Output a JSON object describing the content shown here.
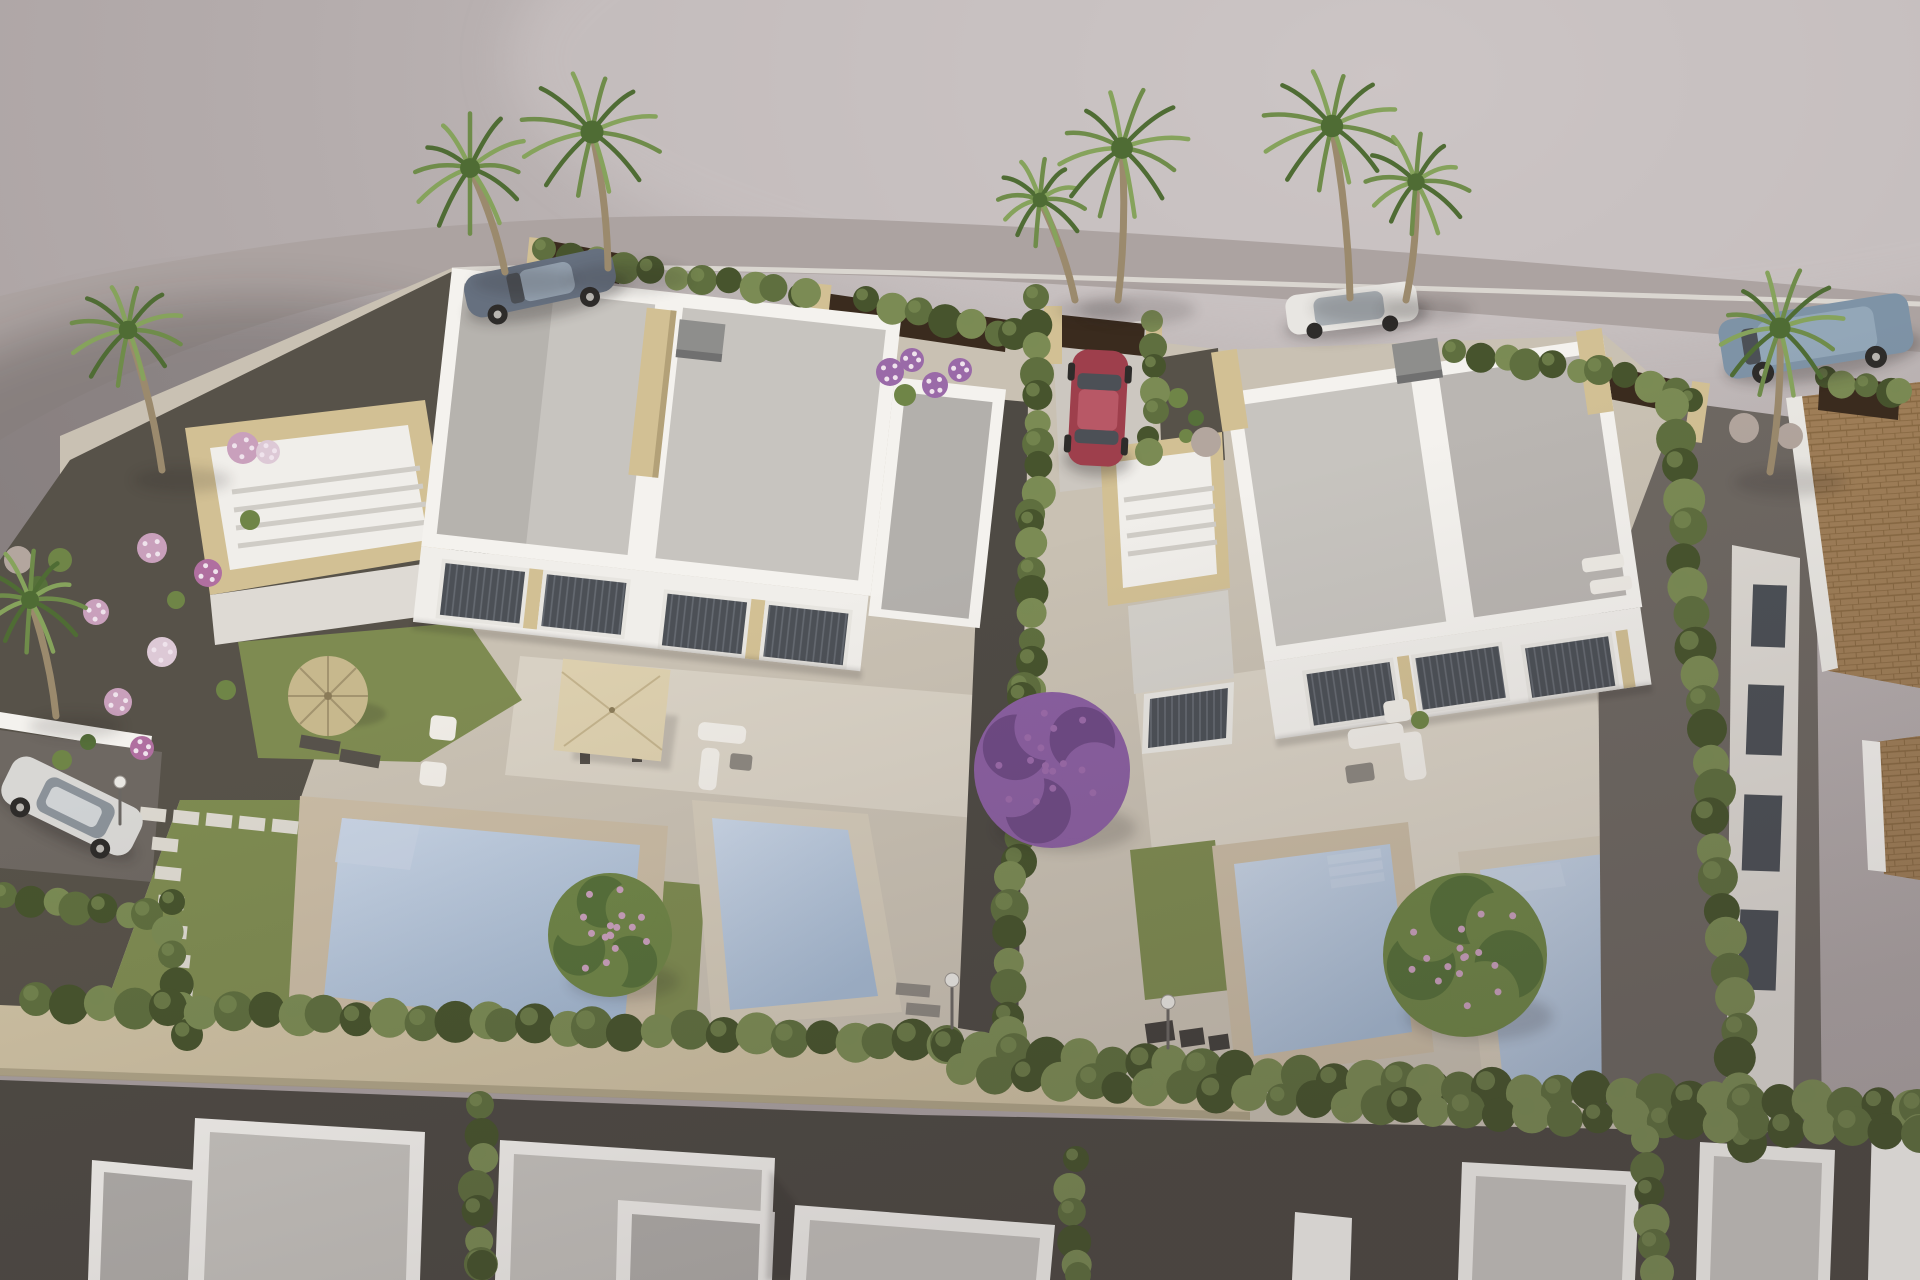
{
  "meta": {
    "description": "Aerial 3D architectural rendering of a new residential development: two white modern semi-detached villas with flat gravel roofs, rooftop solariums, glazed facades, private terraces with parasols and garden furniture, four private swimming pools, lawns, gravel gardens with flowering shrubs, cypress hedges, palm trees, a perimeter stone wall, neighbouring flat-roofed houses below, an existing terracotta-roofed house at right, and five parked cars on the surrounding road."
  },
  "scene": {
    "objects": [
      "left duplex villa",
      "right duplex villa",
      "rooftop solarium left",
      "rooftop solarium right",
      "pool A",
      "pool B",
      "pool C",
      "pool D",
      "straw parasol",
      "beige square parasol",
      "outdoor sofa set",
      "sun loungers",
      "gray sports car",
      "red hatchback",
      "white car",
      "blue SUV",
      "silver hatchback",
      "palm trees",
      "cypress hedges",
      "bougainvillea tree",
      "fruit trees",
      "perimeter stone wall",
      "terracotta roof house",
      "neighbouring flat roofs",
      "street lamps"
    ]
  },
  "palette": {
    "background": "#b4acac",
    "background_light": "#cbc4c4",
    "road": "#aca3a1",
    "plot_base": "#c9c1b3",
    "gravel_garden": "#575249",
    "gravel_path": "#6e6862",
    "dark_path": "#4e4a44",
    "lawn": "#7e8b51",
    "lawn_dark": "#66753f",
    "deck": "#d8d1c4",
    "parapet": "#f4f2ee",
    "roof_gravel": "#c7c4bf",
    "roof_gravel_dark": "#b3b0ac",
    "wall_white": "#f0eeea",
    "wall_shade": "#dedad4",
    "stone": "#d2c094",
    "stone_dark": "#b3a178",
    "window_frame": "#e7e5e0",
    "glass": "#4c5056",
    "blind": "#666b72",
    "pool_stone": "#c9bba4",
    "pool_stone_2": "#d2c9b8",
    "pool_light": "#c6d2e2",
    "wall_stone": "#cec1a3",
    "fence_dark": "#3a2b1e",
    "terracotta": "#a07f58",
    "terracotta_dark": "#84653e",
    "parasol": "#dccfae",
    "parasol_line": "#c2b28c",
    "thatch": "#c7b88d",
    "thatch_line": "#a3946f",
    "trunk": "#9b8a6d",
    "palm_green": "#6f8c4a",
    "palm_dark": "#4f6c34",
    "palm_light": "#86a35c",
    "hedge": "#5f6f3f",
    "hedge_dark": "#47542d",
    "hedge_light": "#7b8b54",
    "canopy_green": "#6f8547",
    "canopy_green_dark": "#56703a",
    "bougainvillea": "#8a5fa0",
    "bougainvillea_dark": "#6e4a84",
    "flower_pink": "#c9a0bc",
    "flower_white": "#ddc9d6",
    "flower_magenta": "#b06fa0",
    "flower_purple": "#9a6aa8",
    "stone_ball": "#b3a69e",
    "car_red": "#9e3f4c",
    "car_red_light": "#b85866",
    "car_gray": "#66707f",
    "car_gray_light": "#93a0ae",
    "car_white": "#e8e6e2",
    "car_suv": "#7e93a6",
    "car_suv_light": "#93a7b8",
    "car_silver": "#d8d7d4",
    "furn_white": "#efece6",
    "furn_dark": "#57524b",
    "furn_gray": "#8c8780",
    "metal": "#6b6763",
    "box_dark": "#45413d",
    "chimney": "#8e8e8c",
    "chimney_dark": "#707070",
    "step_white": "#ebe9e4"
  },
  "vegetation": {
    "hedges_back": [
      {
        "pts": [
          [
            548,
            252
          ],
          [
            700,
            280
          ],
          [
            808,
            294
          ]
        ],
        "r": 14,
        "step": 26
      },
      {
        "pts": [
          [
            868,
            302
          ],
          [
            1010,
            334
          ]
        ],
        "r": 15,
        "step": 26
      },
      {
        "pts": [
          [
            1152,
            324
          ],
          [
            1152,
            452
          ]
        ],
        "r": 13,
        "step": 22
      },
      {
        "pts": [
          [
            1452,
            354
          ],
          [
            1600,
            370
          ],
          [
            1688,
            398
          ]
        ],
        "r": 14,
        "step": 26
      },
      {
        "pts": [
          [
            1822,
            380
          ],
          [
            1900,
            392
          ]
        ],
        "r": 13,
        "step": 24
      }
    ],
    "hedges_mid": [
      {
        "pts": [
          [
            1040,
            300
          ],
          [
            1034,
            520
          ],
          [
            1028,
            690
          ]
        ],
        "r": 15,
        "step": 24
      },
      {
        "pts": [
          [
            1024,
            700
          ],
          [
            1014,
            880
          ],
          [
            1006,
            1035
          ]
        ],
        "r": 17,
        "step": 27
      },
      {
        "pts": [
          [
            1672,
            408
          ],
          [
            1702,
            700
          ],
          [
            1732,
            1000
          ],
          [
            1748,
            1140
          ]
        ],
        "r": 19,
        "step": 30
      },
      {
        "pts": [
          [
            2,
            898
          ],
          [
            148,
            914
          ]
        ],
        "r": 15,
        "step": 26
      },
      {
        "pts": [
          [
            168,
            905
          ],
          [
            186,
            1035
          ]
        ],
        "r": 15,
        "step": 26
      }
    ],
    "hedges_bottom": [
      {
        "pts": [
          [
            40,
            1002
          ],
          [
            500,
            1024
          ],
          [
            948,
            1044
          ]
        ],
        "r": 19,
        "step": 32
      },
      {
        "pts": [
          [
            950,
            1048
          ],
          [
            1430,
            1086
          ],
          [
            1914,
            1108
          ]
        ],
        "r": 19,
        "step": 32
      },
      {
        "pts": [
          [
            962,
            1072
          ],
          [
            1436,
            1110
          ],
          [
            1916,
            1132
          ]
        ],
        "r": 18,
        "step": 32
      },
      {
        "pts": [
          [
            478,
            1108
          ],
          [
            482,
            1268
          ]
        ],
        "r": 16,
        "step": 26
      },
      {
        "pts": [
          [
            1072,
            1162
          ],
          [
            1078,
            1272
          ]
        ],
        "r": 15,
        "step": 26
      },
      {
        "pts": [
          [
            1648,
            1142
          ],
          [
            1654,
            1272
          ]
        ],
        "r": 16,
        "step": 26
      }
    ],
    "palms": [
      {
        "x": 470,
        "y": 168,
        "r": 62,
        "tx": 505,
        "ty": 272
      },
      {
        "x": 592,
        "y": 132,
        "r": 72,
        "tx": 608,
        "ty": 268
      },
      {
        "x": 1040,
        "y": 200,
        "r": 46,
        "tx": 1075,
        "ty": 300
      },
      {
        "x": 1122,
        "y": 148,
        "r": 68,
        "tx": 1118,
        "ty": 300
      },
      {
        "x": 1332,
        "y": 126,
        "r": 70,
        "tx": 1350,
        "ty": 298
      },
      {
        "x": 1416,
        "y": 182,
        "r": 54,
        "tx": 1406,
        "ty": 300
      },
      {
        "x": 1780,
        "y": 328,
        "r": 66,
        "tx": 1770,
        "ty": 472
      },
      {
        "x": 128,
        "y": 330,
        "r": 58,
        "tx": 162,
        "ty": 470
      },
      {
        "x": 30,
        "y": 600,
        "r": 56,
        "tx": 56,
        "ty": 716
      }
    ],
    "shrubs": [
      {
        "x": 243,
        "y": 448,
        "r": 16,
        "c": "flower_pink"
      },
      {
        "x": 268,
        "y": 452,
        "r": 12,
        "c": "flower_white"
      },
      {
        "x": 152,
        "y": 548,
        "r": 15,
        "c": "flower_pink"
      },
      {
        "x": 208,
        "y": 573,
        "r": 14,
        "c": "flower_magenta"
      },
      {
        "x": 96,
        "y": 612,
        "r": 13,
        "c": "flower_pink"
      },
      {
        "x": 162,
        "y": 652,
        "r": 15,
        "c": "flower_white"
      },
      {
        "x": 118,
        "y": 702,
        "r": 14,
        "c": "flower_pink"
      },
      {
        "x": 142,
        "y": 748,
        "r": 12,
        "c": "flower_magenta"
      },
      {
        "x": 226,
        "y": 690,
        "r": 10,
        "c": "canopy_green"
      },
      {
        "x": 176,
        "y": 600,
        "r": 9,
        "c": "canopy_green"
      },
      {
        "x": 60,
        "y": 560,
        "r": 12,
        "c": "canopy_green"
      },
      {
        "x": 250,
        "y": 520,
        "r": 10,
        "c": "canopy_green"
      },
      {
        "x": 62,
        "y": 760,
        "r": 10,
        "c": "canopy_green"
      },
      {
        "x": 88,
        "y": 742,
        "r": 8,
        "c": "canopy_green_dark"
      },
      {
        "x": 890,
        "y": 372,
        "r": 14,
        "c": "flower_purple"
      },
      {
        "x": 912,
        "y": 360,
        "r": 12,
        "c": "flower_purple"
      },
      {
        "x": 935,
        "y": 385,
        "r": 13,
        "c": "flower_purple"
      },
      {
        "x": 960,
        "y": 370,
        "r": 12,
        "c": "flower_purple"
      },
      {
        "x": 905,
        "y": 395,
        "r": 11,
        "c": "canopy_green"
      },
      {
        "x": 1178,
        "y": 398,
        "r": 10,
        "c": "canopy_green"
      },
      {
        "x": 1196,
        "y": 418,
        "r": 8,
        "c": "canopy_green_dark"
      },
      {
        "x": 1186,
        "y": 436,
        "r": 7,
        "c": "canopy_green"
      },
      {
        "x": 1206,
        "y": 442,
        "r": 15,
        "c": "stone_ball"
      },
      {
        "x": 1744,
        "y": 428,
        "r": 15,
        "c": "stone_ball"
      },
      {
        "x": 1790,
        "y": 436,
        "r": 13,
        "c": "stone_ball"
      },
      {
        "x": 18,
        "y": 560,
        "r": 14,
        "c": "stone_ball"
      },
      {
        "x": 38,
        "y": 586,
        "r": 10,
        "c": "canopy_green_dark"
      }
    ],
    "canopies": [
      {
        "x": 610,
        "y": 935,
        "r": 62,
        "c": "canopy_green",
        "dots": "flower_pink"
      },
      {
        "x": 1052,
        "y": 770,
        "r": 78,
        "c": "bougainvillea",
        "dots": "flower_purple"
      },
      {
        "x": 1465,
        "y": 955,
        "r": 82,
        "c": "canopy_green",
        "dots": "flower_pink"
      }
    ],
    "stepping_stones": [
      {
        "x0": 140,
        "y0": 808,
        "dx": 33,
        "dy": 3,
        "n": 6,
        "w": 26,
        "h": 13,
        "rot": 6
      },
      {
        "x0": 152,
        "y0": 838,
        "dx": 3,
        "dy": 29,
        "n": 6,
        "w": 26,
        "h": 13,
        "rot": 6
      }
    ]
  }
}
